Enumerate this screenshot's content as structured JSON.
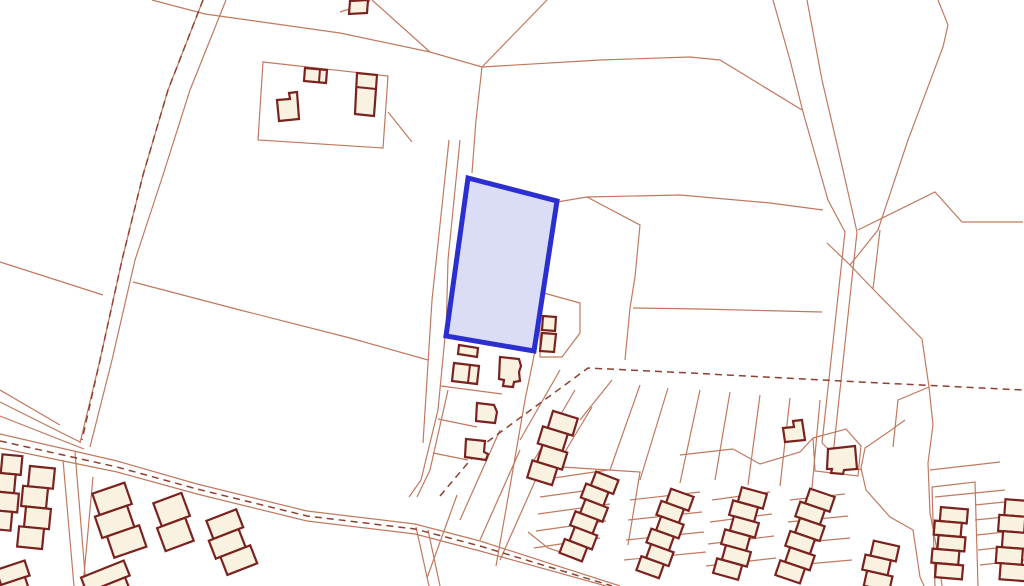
{
  "map": {
    "kind": "cadastral-site-plan",
    "width": 1024,
    "height": 586,
    "colors": {
      "background": "#ffffff",
      "boundary_line": "#c0795f",
      "dash_line": "#8e4130",
      "building_outline": "#7a2220",
      "building_fill": "#f9f2e0",
      "highlight_fill": "#d8dbf4",
      "highlight_stroke": "#2b2fd0"
    },
    "highlight_parcel": {
      "name": "highlighted-parcel",
      "d": "M468,178 L557,201 L534,351 L446,336 Z",
      "stroke_width": 5
    },
    "boundary_lines": [
      "M203,0 L168,90 L143,175 L122,260 L100,360 L80,443",
      "M226,0 L190,90 L163,175 L135,260 L112,360 L90,447",
      "M0,402 L80,442",
      "M0,416 L84,449",
      "M0,390 L60,425",
      "M0,434 L117,461 L197,484 L307,511 L415,524 L480,541 L620,586",
      "M0,448 L117,472 L197,494 L307,521 L415,534 L480,551 L606,586",
      "M75,452 L86,586",
      "M63,460 L74,586",
      "M93,477 L83,586",
      "M0,262 L50,278 L103,295",
      "M133,282 L240,310 L350,338 L428,360",
      "M152,0 L205,14 L340,33 L430,52 L482,67",
      "M372,0 L430,52",
      "M340,12 L368,3 L370,0",
      "M482,67 L547,0",
      "M482,67 L600,60 L690,57 L720,60 L802,110",
      "M482,67 L476,120 L472,173",
      "M449,140 L432,300 L423,443",
      "M460,140 L448,260 L446,336",
      "M388,112 L412,142",
      "M263,62 L388,76 L383,148 L258,140 Z",
      "M557,202 L587,197 L680,195 L770,203 L823,210",
      "M587,197 L640,225 L635,277 L630,308 L625,360",
      "M633,308 L700,309 L822,312",
      "M540,292 L580,303 L580,333 L562,357 L540,357 Z",
      "M445,337 L438,410 L421,480 L409,497",
      "M448,390 L430,470 L417,497",
      "M416,527 L429,586",
      "M428,530 L440,586",
      "M441,386 L502,394",
      "M438,419 L477,427",
      "M433,453 L468,460",
      "M535,351 L525,400 L512,475 L496,566",
      "M560,370 L520,440",
      "M575,390 L533,462",
      "M592,407 L548,480",
      "M500,430 L460,520",
      "M520,450 L480,540",
      "M540,470 L500,560",
      "M457,495 L427,578",
      "M773,0 L790,60 L803,112 L828,200 L845,232 L822,443",
      "M807,0 L822,80 L843,170 L857,232 L833,455",
      "M938,0 L948,25 L943,47 L908,140 L878,230 L850,265",
      "M827,243 L850,265 L873,289",
      "M880,230 L873,289 L922,339 L929,387 L898,400 L893,447",
      "M929,387 L933,425 L928,463 L930,513",
      "M858,230 L935,192 L962,222 L1023,222",
      "M905,420 L887,433 L865,448 L861,468 L866,490 L890,517 L913,530 L920,577 L924,586",
      "M930,513 L938,555 L942,586",
      "M822,443 L840,460 L861,470",
      "M680,455 L733,449",
      "M733,449 L760,464 L800,452 L813,438",
      "M813,438 L846,429 L861,446 L858,476 L815,471 L813,438",
      "M930,470 L1000,462",
      "M935,497 L1005,490",
      "M932,487 L975,482 L978,586",
      "M932,487 L935,586",
      "M975,505 L1024,500",
      "M975,520 L1024,515",
      "M977,535 L1024,530",
      "M978,550 L1024,545",
      "M980,565 L1024,560",
      "M540,480 L608,470",
      "M540,497 L612,487",
      "M538,514 L610,504",
      "M536,531 L606,521",
      "M534,548 L600,538",
      "M562,467 L640,472 L628,545",
      "M630,500 L700,492",
      "M628,520 L702,512",
      "M626,540 L704,532",
      "M624,560 L706,552",
      "M712,500 L770,492",
      "M710,522 L772,514",
      "M708,544 L774,536",
      "M706,566 L776,558",
      "M790,500 L845,494",
      "M788,522 L848,516",
      "M786,544 L850,538",
      "M784,566 L852,560",
      "M612,380 L580,420",
      "M640,385 L610,470",
      "M668,388 L640,480",
      "M700,390 L680,483",
      "M730,392 L715,480",
      "M760,395 L748,485",
      "M790,398 L780,486",
      "M820,400 L812,488",
      "M528,532 L548,548 L578,558"
    ],
    "dashed_lines": [
      "M203,0 L168,90 L143,175 L122,260 L100,360 L82,440",
      "M0,441 L117,467 L197,489 L307,516 L415,529 L480,546 L612,586",
      "M440,496 L483,445 L588,368 L690,373 L860,382 L1023,390"
    ],
    "buildings": [
      "M305,68 L327,70 L326,83 L304,81 Z",
      "M277,100 L290,99 L289,93 L297,92 L299,119 L279,121 Z",
      "M357,73 L377,75 L374,116 L355,114 Z",
      "M350,1 L368,0 L367,13 L349,14 Z",
      "M459,345 L478,348 L477,357 L458,354 Z",
      "M454,363 L479,366 L477,384 L452,381 Z",
      "M500,357 L519,359 L521,366 L519,372 L520,381 L514,382 L513,387 L503,386 L504,380 L499,379 Z",
      "M477,403 L494,405 L497,412 L495,423 L476,421 Z",
      "M466,439 L485,441 L484,452 L488,454 L486,460 L465,457 Z",
      "M543,316 L556,317 L555,331 L542,330 Z",
      "M542,333 L556,334 L554,352 L540,351 Z",
      "M828,449 L855,446 L857,469 L844,470 L843,474 L831,473 L832,469 L827,469 Z",
      "M783,428 L794,427 L793,421 L802,420 L805,440 L785,442 Z"
    ],
    "building_dividers": [
      "M320,69 L319,82",
      "M356,87 L376,89",
      "M470,365 L468,383"
    ],
    "terrace_chains": [
      {
        "x1": 563,
        "y1": 414,
        "x2": 542,
        "y2": 482,
        "units": 4,
        "w": 26
      },
      {
        "x1": 605,
        "y1": 475,
        "x2": 573,
        "y2": 558,
        "units": 6,
        "w": 24
      },
      {
        "x1": 680,
        "y1": 492,
        "x2": 650,
        "y2": 575,
        "units": 6,
        "w": 24
      },
      {
        "x1": 752,
        "y1": 490,
        "x2": 728,
        "y2": 577,
        "units": 6,
        "w": 26
      },
      {
        "x1": 820,
        "y1": 492,
        "x2": 790,
        "y2": 580,
        "units": 6,
        "w": 26
      },
      {
        "x1": 952,
        "y1": 508,
        "x2": 946,
        "y2": 578,
        "units": 5,
        "w": 27
      },
      {
        "x1": 1016,
        "y1": 500,
        "x2": 1010,
        "y2": 580,
        "units": 5,
        "w": 26
      },
      {
        "x1": 884,
        "y1": 543,
        "x2": 874,
        "y2": 588,
        "units": 3,
        "w": 26
      },
      {
        "x1": 106,
        "y1": 489,
        "x2": 128,
        "y2": 553,
        "units": 3,
        "w": 34
      },
      {
        "x1": 165,
        "y1": 499,
        "x2": 182,
        "y2": 545,
        "units": 2,
        "w": 30
      },
      {
        "x1": 219,
        "y1": 516,
        "x2": 240,
        "y2": 570,
        "units": 3,
        "w": 32
      },
      {
        "x1": 100,
        "y1": 570,
        "x2": 112,
        "y2": 600,
        "units": 2,
        "w": 46
      },
      {
        "x1": 8,
        "y1": 566,
        "x2": 18,
        "y2": 596,
        "units": 2,
        "w": 30
      },
      {
        "x1": 10,
        "y1": 455,
        "x2": 3,
        "y2": 530,
        "units": 4,
        "w": 20
      },
      {
        "x1": 40,
        "y1": 467,
        "x2": 32,
        "y2": 548,
        "units": 4,
        "w": 25
      }
    ]
  }
}
